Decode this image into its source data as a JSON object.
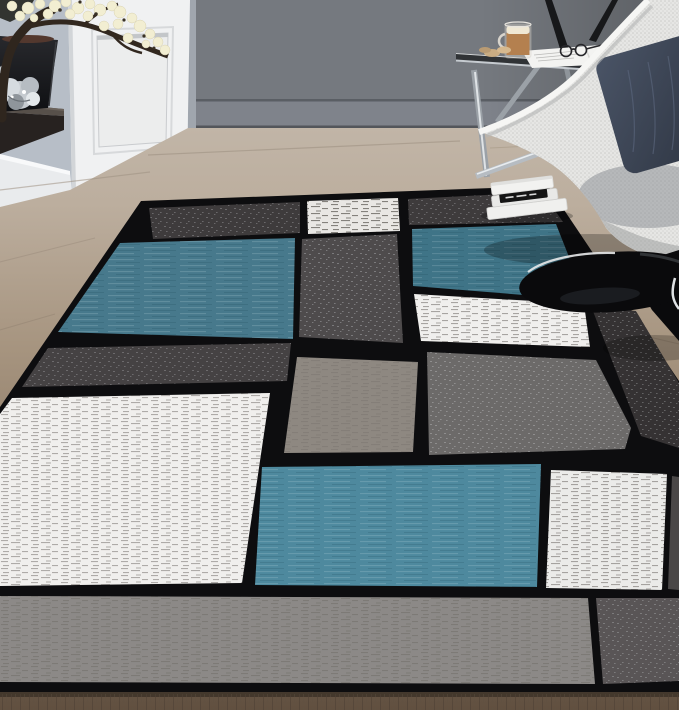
{
  "scene": {
    "type": "product-photo",
    "subject": "modern geometric color-block area rug in a living room",
    "room_elements": [
      "gray wall",
      "white paneled door",
      "light blue-gray wall",
      "wood floor",
      "floating dark shelf",
      "black planter with blossom branch",
      "silver sculpture",
      "chrome glass side table",
      "tripod lamp legs",
      "white mesh pod chair",
      "dark pillow",
      "stack of white books",
      "black gloss round table"
    ],
    "rug_pattern": "boxes of charcoal, gray, taupe, white and teal-blue separated by thick black lines"
  },
  "colors": {
    "wall_dark": "#75797f",
    "wall_baseboard": "#7f838b",
    "wall_light": "#b7bec7",
    "door_white": "#f0f1f2",
    "door_panel": "#eceded",
    "baseboard_white": "#e9ebed",
    "rug_black": "#0d0d0f",
    "rug_charcoal": "#3e3b3c",
    "rug_charcoal_deep": "#353233",
    "rug_gray_column": "#4e4b4c",
    "rug_gray_row": "#454243",
    "rug_gray_medium": "#6c6a69",
    "rug_taupe": "#8e8881",
    "rug_white": "#f0efed",
    "rug_white_dim": "#e9e7e4",
    "rug_white_sq": "#ebebe9",
    "rug_blue": "#47798c",
    "rug_blue_right": "#3f7487",
    "rug_blue_bottom": "#4e899e",
    "rug_band_gray": "#8c8987",
    "rug_band_dark": "#595556",
    "rug_sliver_dark": "#4a4747",
    "chair_shell": "#e6e6e4",
    "table_black": "#0a0a0c",
    "chrome": "#a7adb3",
    "book_white": "#f0f0ee",
    "book_black": "#151515",
    "blossom": "#f2eed2",
    "branch": "#2f261e",
    "pot_black": "#1b1c1f",
    "shelf_top": "#57504a",
    "shelf_front": "#272220",
    "silver": "#c6cbd0",
    "coffee": "#b4804f",
    "foam": "#f0e8d4",
    "cookie": "#c9ac83",
    "glass_band": "#2c2f33",
    "magazine": "#f3f3f1",
    "lamp_black": "#17181a"
  }
}
